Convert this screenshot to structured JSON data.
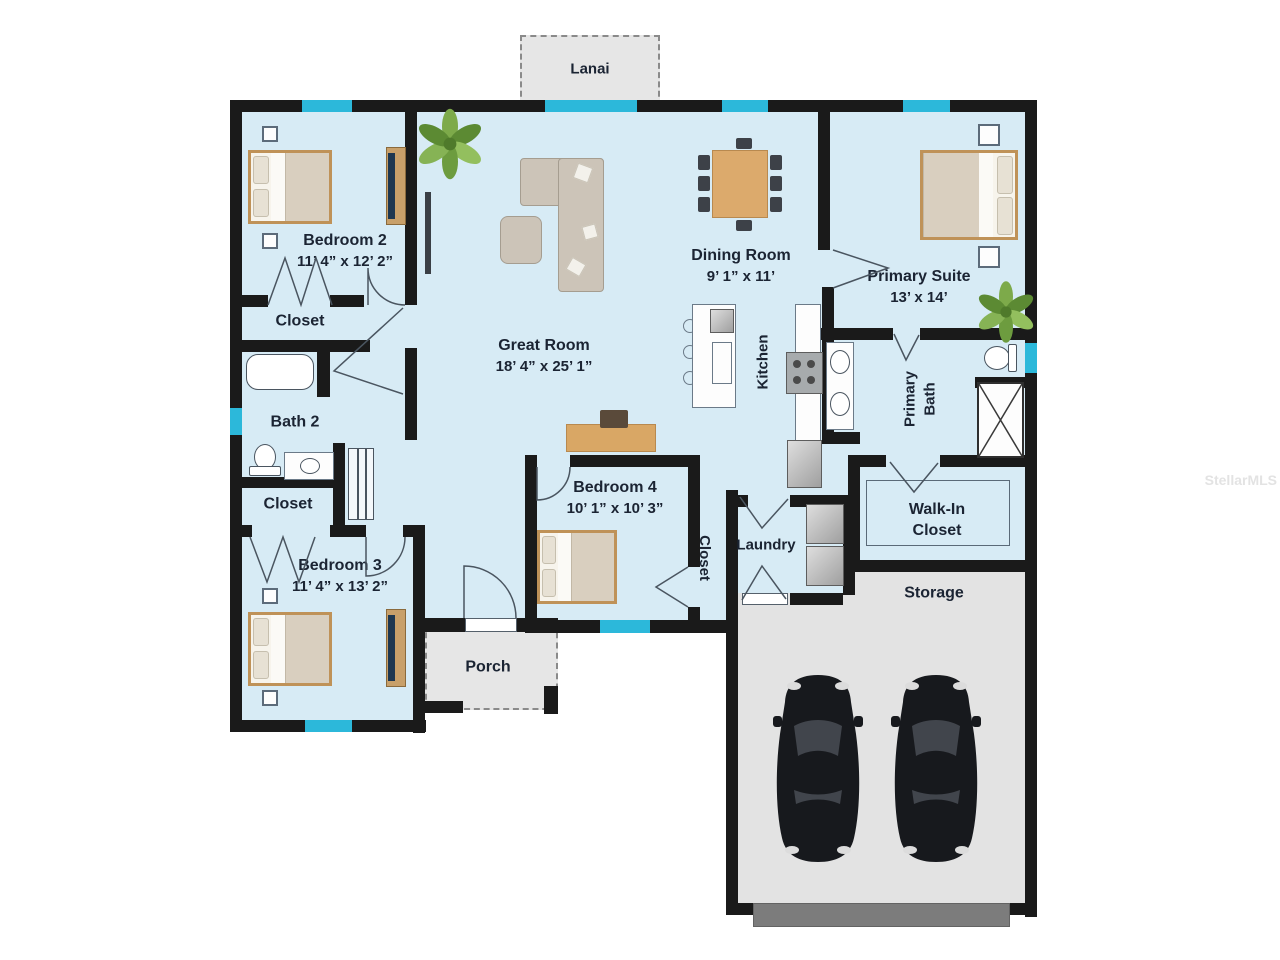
{
  "watermark": "StellarMLS",
  "colors": {
    "floor": "#d7ebf5",
    "wall": "#1a1a1a",
    "window_accent": "#2cb8da",
    "outdoor_gray": "#e6e6e6",
    "garage_floor": "#e3e3e3",
    "label_text": "#1b2433"
  },
  "rooms": {
    "lanai": {
      "label": "Lanai"
    },
    "bedroom2": {
      "label": "Bedroom 2",
      "dims": "11’ 4” x 12’ 2”"
    },
    "bedroom2_closet": {
      "label": "Closet"
    },
    "bath2": {
      "label": "Bath 2"
    },
    "bedroom3_closet": {
      "label": "Closet"
    },
    "bedroom3": {
      "label": "Bedroom 3",
      "dims": "11’ 4” x 13’ 2”"
    },
    "great_room": {
      "label": "Great Room",
      "dims": "18’ 4” x 25’ 1”"
    },
    "dining_room": {
      "label": "Dining Room",
      "dims": "9’ 1” x 11’"
    },
    "kitchen": {
      "label": "Kitchen"
    },
    "primary_suite": {
      "label": "Primary Suite",
      "dims": "13’ x 14’"
    },
    "primary_bath": {
      "line1": "Primary",
      "line2": "Bath"
    },
    "walk_in_closet": {
      "line1": "Walk-In",
      "line2": "Closet"
    },
    "bedroom4": {
      "label": "Bedroom 4",
      "dims": "10’ 1” x 10’ 3”"
    },
    "bedroom4_closet": {
      "label": "Closet"
    },
    "laundry": {
      "label": "Laundry"
    },
    "storage": {
      "label": "Storage"
    },
    "porch": {
      "label": "Porch"
    }
  }
}
